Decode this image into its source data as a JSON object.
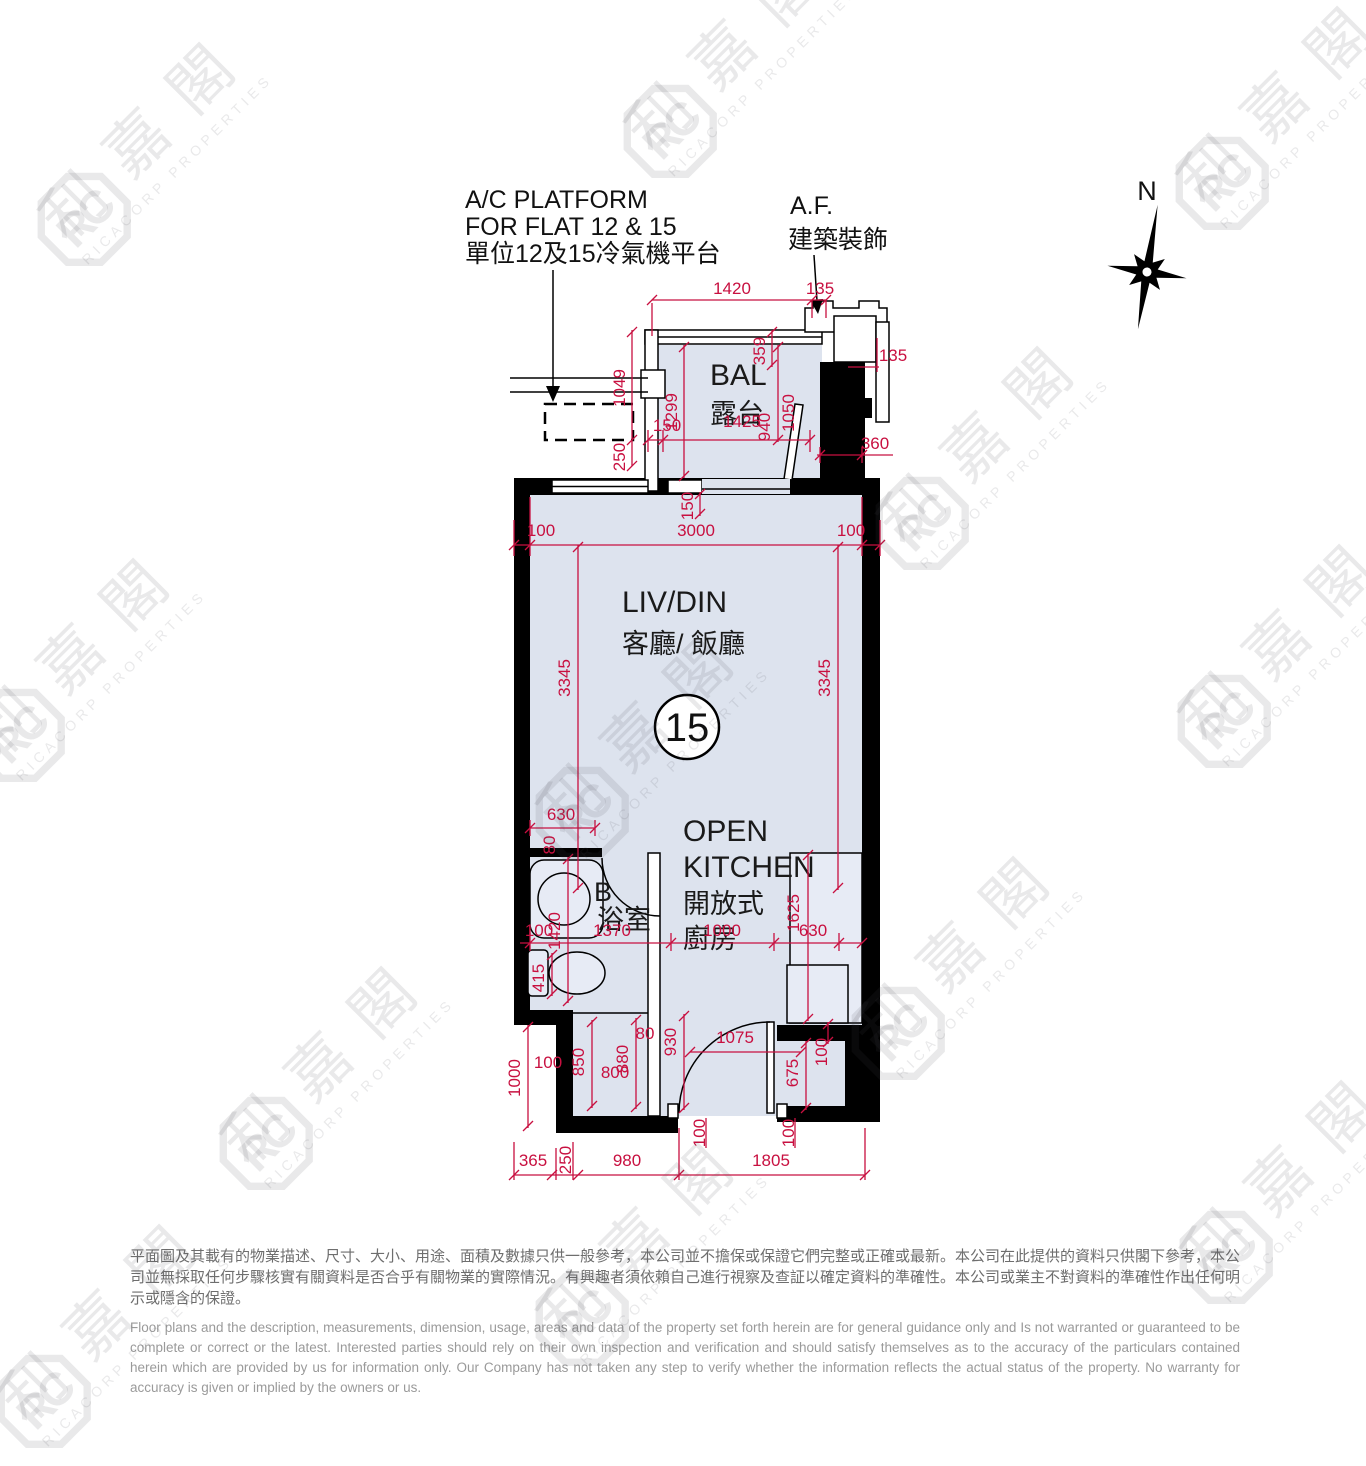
{
  "watermark": {
    "zh": "利嘉閣",
    "en": "RICACORP PROPERTIES",
    "logo": "RC"
  },
  "plan": {
    "north_label": "N",
    "unit_number": "15",
    "colors": {
      "dimension": "#c81040",
      "wall": "#000000",
      "floor": "#dde3ee",
      "watermark": "#e8e8e8"
    },
    "annotations": {
      "ac_platform_line1": "A/C PLATFORM",
      "ac_platform_line2": "FOR FLAT 12 & 15",
      "ac_platform_line3": "單位12及15冷氣機平台",
      "af_line1": "A.F.",
      "af_line2": "建築裝飾"
    },
    "rooms": {
      "balcony_en": "BAL",
      "balcony_zh": "露台",
      "living_en": "LIV/DIN",
      "living_zh": "客廳/ 飯廳",
      "kitchen_en_line1": "OPEN",
      "kitchen_en_line2": "KITCHEN",
      "kitchen_zh_line1": "開放式",
      "kitchen_zh_line2": "廚房",
      "bath_en": "B",
      "bath_zh": "浴室"
    },
    "dims": {
      "top_1420": "1420",
      "top_135": "135",
      "af_135": "135",
      "bal_360": "360",
      "bal_1049": "1049",
      "bal_250": "250",
      "bal_1299": "1299",
      "bal_359": "359",
      "bal_940": "940",
      "bal_1050": "1050",
      "bal_150": "150",
      "bal_1425": "1425",
      "liv_100_left": "100",
      "liv_3000": "3000",
      "liv_100_right": "100",
      "liv_150": "150",
      "liv_3345_left": "3345",
      "liv_3345_right": "3345",
      "bath_630": "630",
      "bath_80": "80",
      "bath_1420": "1420",
      "bath_100": "100",
      "bath_1370": "1370",
      "kit_1000": "1000",
      "kit_630": "630",
      "kit_1625": "1625",
      "bath_415": "415",
      "bl_1000": "1000",
      "bl_100": "100",
      "bl_850": "850",
      "bl_880": "880",
      "bl_800": "800",
      "bl_80": "80",
      "ent_930": "930",
      "ent_1075": "1075",
      "ent_100_left": "100",
      "ent_100_right": "100",
      "rec_675": "675",
      "rec_100_top": "100",
      "bot_365": "365",
      "bot_250": "250",
      "bot_980": "980",
      "bot_1805": "1805"
    }
  },
  "disclaimer": {
    "zh": "平面圖及其載有的物業描述、尺寸、大小、用途、面積及數據只供一般參考，本公司並不擔保或保證它們完整或正確或最新。本公司在此提供的資料只供閣下參考，本公司並無採取任何步驟核實有關資料是否合乎有關物業的實際情況。有興趣者須依賴自己進行視察及查証以確定資料的準確性。本公司或業主不對資料的準確性作出任何明示或隱含的保證。",
    "en": "Floor plans and the description, measurements, dimension, usage, areas and data of the property set forth herein are for general guidance only and Is not warranted or guaranteed to be complete or correct or the latest. Interested parties should rely on their own inspection and verification and should satisfy themselves as to the accuracy of the particulars contained herein which are provided by us for information only. Our Company has not taken any step to verify whether the information reflects the actual status of the property. No warranty for accuracy is given or implied by the owners or us."
  }
}
